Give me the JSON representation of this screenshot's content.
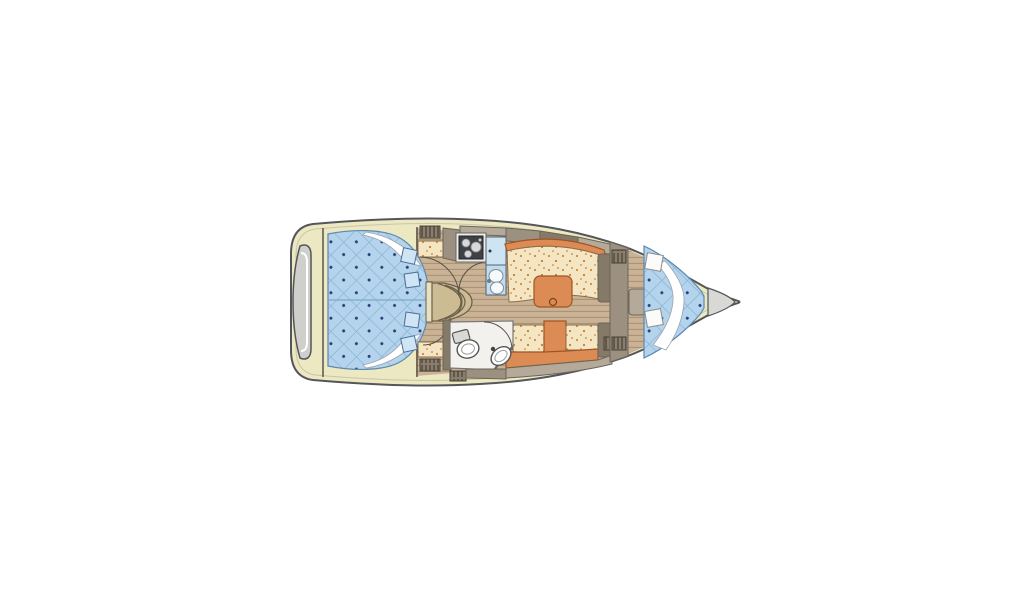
{
  "meta": {
    "description": "Top-down sailboat interior floor plan: aft double cabin, companionway steps, galley with stove and double sink, salon with orange table and settees, head with toilet and washbasin, forward V-berth cabin, rounded bow locker and stern swim platform",
    "orientation": "bow-right"
  },
  "colors": {
    "background": "#ffffff",
    "hull_outline": "#55565a",
    "deck_cream": "#ece8c2",
    "stern_gray": "#cfcfcb",
    "bow_gray": "#d8d8d4",
    "berth_blue": "#b3d4ec",
    "quilt_line": "#86afd4",
    "quilt_button": "#26407a",
    "wood_floor": "#c9b295",
    "wood_line": "#a6906f",
    "furniture_taupe": "#9c9080",
    "furniture_taupe_dark": "#857968",
    "furniture_taupe_light": "#b5aa99",
    "cushion_cream": "#f4e6c3",
    "cushion_speckle": "#d08a3e",
    "accent_orange": "#dc8b54",
    "accent_orange_dark": "#9e5526",
    "sink_blue": "#cde4f2",
    "head_floor": "#f2f1ee",
    "outline_dark": "#5a544a"
  },
  "areas": {
    "aft_cabin": "aft double berth",
    "companionway": "companionway steps",
    "galley": "galley",
    "salon": "salon with table",
    "head": "head / bathroom",
    "v_berth": "forward V-berth",
    "bow_locker": "anchor locker",
    "swim_platform": "stern platform"
  }
}
